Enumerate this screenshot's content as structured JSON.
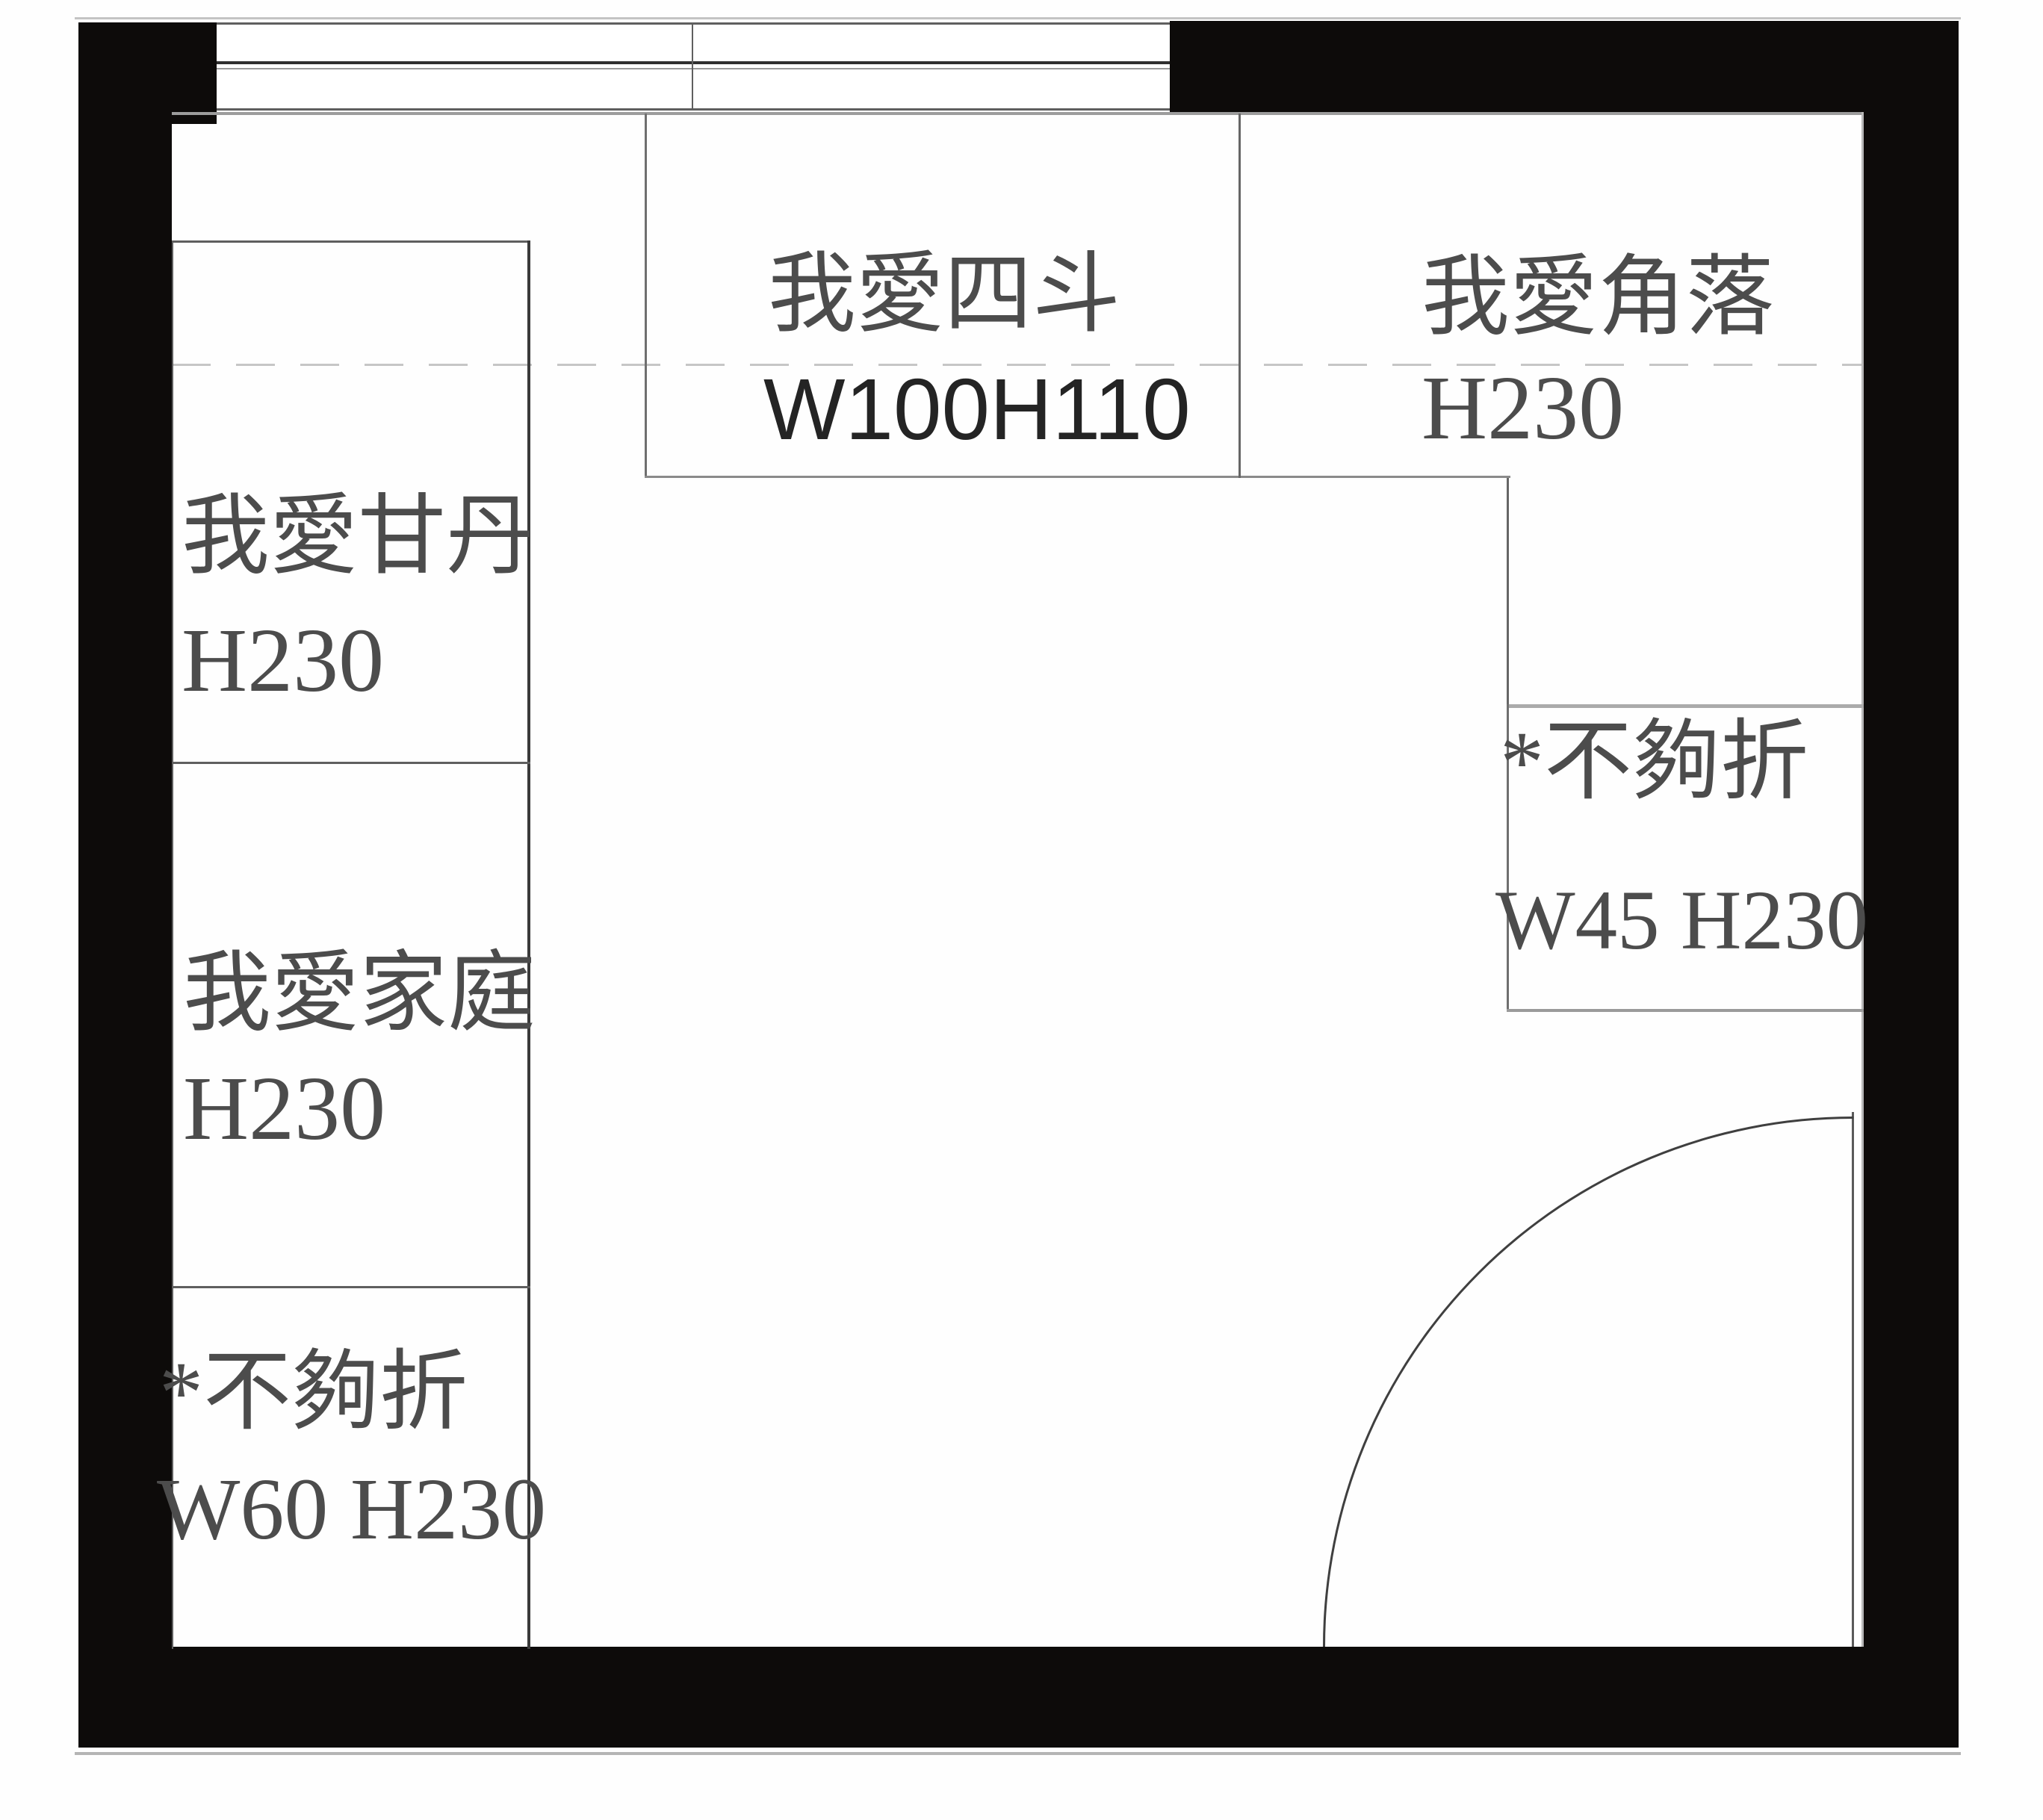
{
  "colors": {
    "bg": "#fefefe",
    "wall": "#0d0b0a",
    "line": "#5f5f5f",
    "line-dark": "#3f3f3f",
    "line-light": "#9c9c9c",
    "dash": "#c6c6c6",
    "txt": "#4c4c4c",
    "txt-dark": "#242424"
  },
  "cabinets": {
    "left_column": {
      "sections": [
        {
          "label": "我愛甘丹",
          "dimension": "H230"
        },
        {
          "label": "我愛家庭",
          "dimension": "H230"
        },
        {
          "label": "*不夠折",
          "dimension": "W60 H230"
        }
      ]
    },
    "top_row": {
      "chest": {
        "label": "我愛四斗",
        "dimension": "W100H110"
      },
      "corner": {
        "label": "我愛角落",
        "dimension": "H230"
      }
    },
    "right_side": {
      "fold": {
        "label": "*不夠折",
        "dimension": "W45 H230"
      }
    }
  }
}
